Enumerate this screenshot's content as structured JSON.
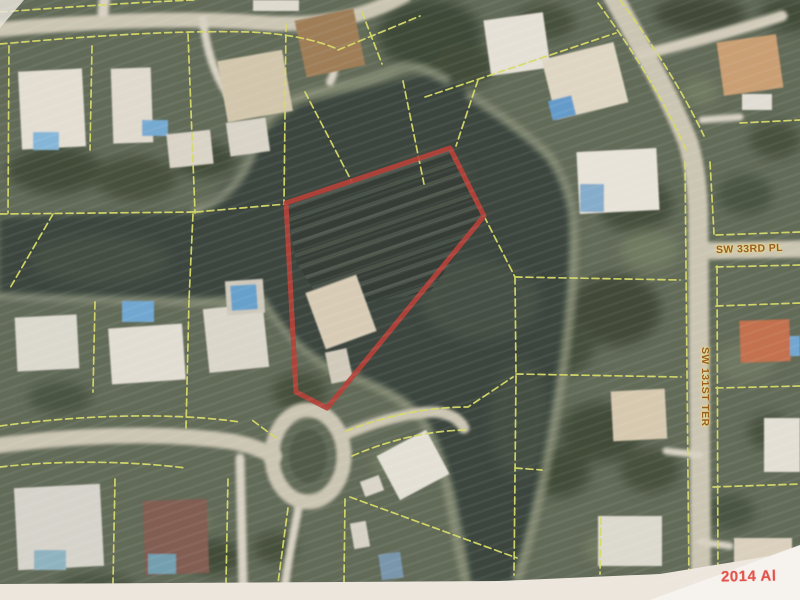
{
  "map": {
    "street_labels": [
      {
        "name": "sw-33rd-pl",
        "text": "SW 33RD PL"
      },
      {
        "name": "sw-131st-ter",
        "text": "SW 131ST TER"
      }
    ],
    "watermark_text": "2014 Al",
    "red_parcel": {
      "points_str": "450,148 484,216 327,408 296,392 286,203",
      "stroke_color": "#b23830"
    },
    "colors": {
      "parcel_line_yellow": "#d4d75f",
      "water_dark": "#333d34",
      "land_green": "#57604c",
      "road_tan": "#c9c2af",
      "street_label_text": "#9c5e1e",
      "watermark_red": "#e2544e",
      "photo_border": "#ece5dc"
    }
  }
}
